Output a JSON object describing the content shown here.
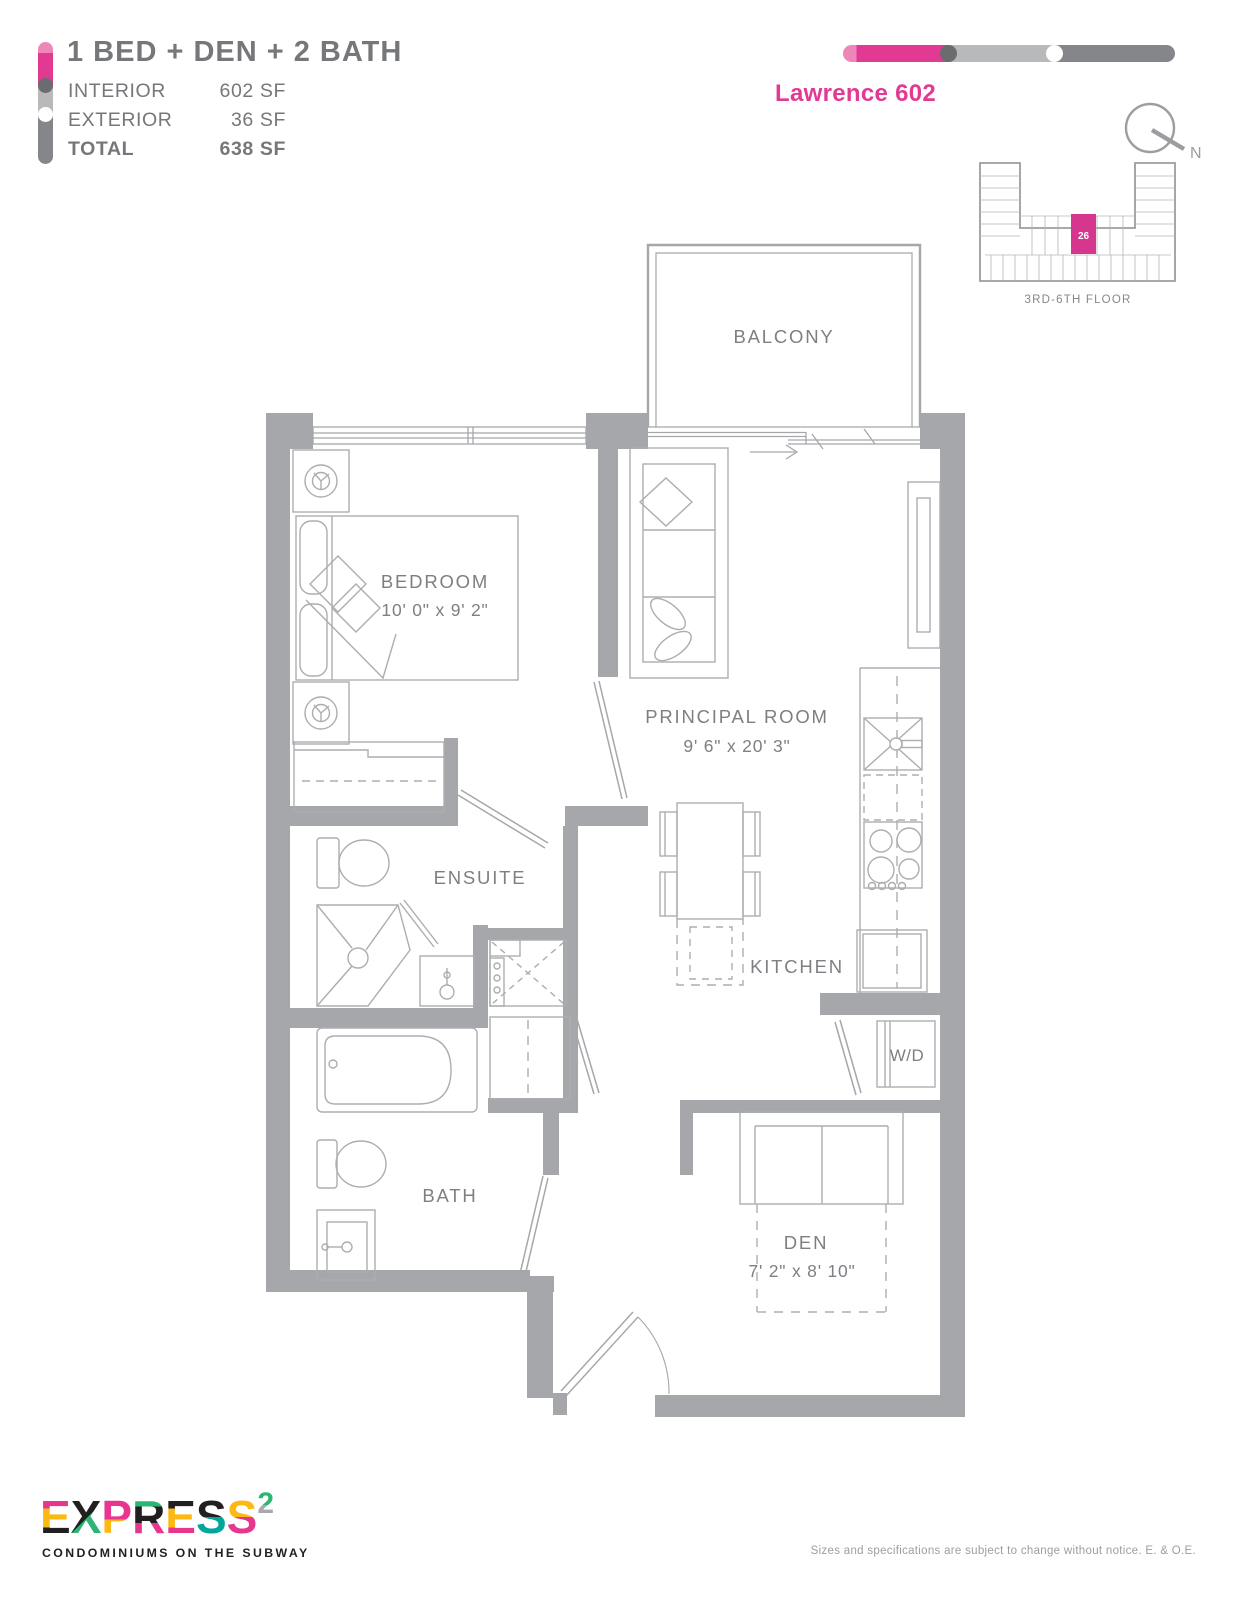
{
  "header": {
    "plan_type": "1 BED + DEN + 2 BATH",
    "areas": [
      {
        "label": "INTERIOR",
        "value": "602 SF"
      },
      {
        "label": "EXTERIOR",
        "value": "36 SF"
      },
      {
        "label": "TOTAL",
        "value": "638 SF"
      }
    ],
    "unit_name": "Lawrence 602"
  },
  "keyplan": {
    "floor_label": "3RD-6TH FLOOR",
    "unit_number": "26",
    "north_label": "N"
  },
  "floorplan": {
    "rooms": {
      "balcony": {
        "label": "BALCONY"
      },
      "bedroom": {
        "label": "BEDROOM",
        "dimensions": "10' 0\" x 9' 2\""
      },
      "principal": {
        "label": "PRINCIPAL ROOM",
        "dimensions": "9' 6\" x 20' 3\""
      },
      "ensuite": {
        "label": "ENSUITE"
      },
      "kitchen": {
        "label": "KITCHEN"
      },
      "bath": {
        "label": "BATH"
      },
      "den": {
        "label": "DEN",
        "dimensions": "7' 2\" x 8' 10\""
      },
      "washer_dryer": {
        "label": "W/D"
      }
    }
  },
  "footer": {
    "logo_letters": [
      "E",
      "X",
      "P",
      "R",
      "E",
      "S",
      "S"
    ],
    "logo_superscript": "2",
    "tagline": "CONDOMINIUMS ON THE SUBWAY",
    "disclaimer": "Sizes and specifications are subject to change without notice. E. & O.E."
  },
  "colors": {
    "magenta": "#e23a93",
    "light_pink": "#ee87b8",
    "wall_gray": "#a5a7aa",
    "text_gray": "#76777a",
    "line_gray": "#abadaf"
  }
}
